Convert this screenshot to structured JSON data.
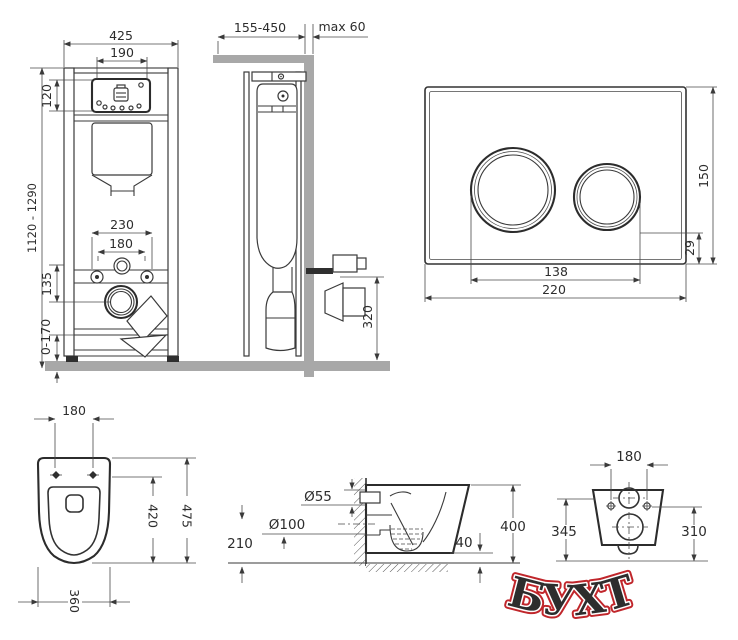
{
  "watermark": {
    "text": "БУХТА",
    "color": "#c0262b"
  },
  "views": {
    "frame_front": {
      "dims": {
        "width": "425",
        "window_width": "190",
        "window_height": "120",
        "height_range": "1120 - 1290",
        "stud_span": "230",
        "supply_span": "180",
        "outlet_drop": "135",
        "feet_range": "0-170"
      }
    },
    "frame_side": {
      "dims": {
        "depth_range": "155-450",
        "wall_max": "max 60",
        "outlet_height": "320"
      }
    },
    "flush_plate": {
      "dims": {
        "width": "220",
        "height": "150",
        "button_span": "138",
        "bottom_margin": "29"
      }
    },
    "bowl_top": {
      "dims": {
        "hole_span": "180",
        "length": "475",
        "inner_length": "420",
        "width": "360"
      }
    },
    "bowl_side": {
      "dims": {
        "inlet_dia": "Ø55",
        "outlet_dia": "Ø100",
        "outlet_height": "210",
        "clearance": "40",
        "height": "400"
      }
    },
    "bowl_back": {
      "dims": {
        "hole_span": "180",
        "left_height": "345",
        "right_height": "310"
      }
    }
  }
}
